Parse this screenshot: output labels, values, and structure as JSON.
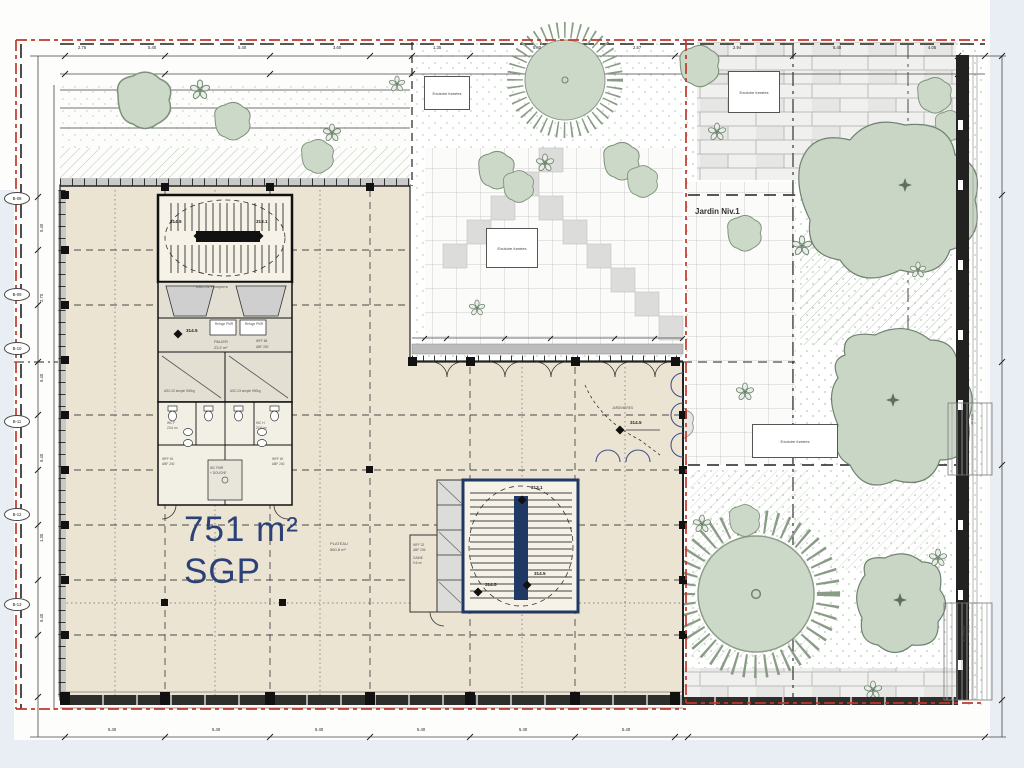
{
  "main_floor": {
    "area": "751 m²",
    "name": "SGP",
    "plateau_label": "PLATEAU",
    "plateau_area": "560.8 m²"
  },
  "garden": {
    "name": "Jardin Niv.1",
    "vent_label": "Exutoire fumées",
    "planters_label": "JARDINIÈRES",
    "terrace_label": "TERRASSE",
    "terrace_area": "30.8 m²"
  },
  "core1": {
    "stair_left_level": "314.5",
    "stair_right_level": "313.1",
    "lobby_level": "314.5",
    "elevator1": "ASC.01 Pompiers",
    "elevator2": "ASC.02 simple 900kg",
    "elevator3": "ASC.03 simple 900kg",
    "refuge": "Refuge PMR",
    "palier": "PALIER",
    "palier_area": "23.2 m²",
    "wff68": "WFF 68",
    "abf250": "ABF 250"
  },
  "wc": {
    "wc_f": "WC F",
    "wc_h": "WC H",
    "wc_area": "23.6 m²",
    "wc_pmr": "WC PMR",
    "douche": "+ DOUCHE",
    "wff40": "WFF 40",
    "abf240": "ABF 240"
  },
  "core2": {
    "top_level": "313.1",
    "bottom_level": "314.5",
    "side_level": "314.5",
    "wff32": "WFF 32",
    "abf206": "ABF 206",
    "gaine": "GAINE",
    "gaine_area": "9.6 m²"
  },
  "garden_spot_level": "314.5",
  "grid_bubbles": [
    "B-08",
    "B-09",
    "B-10",
    "B-11",
    "B-12",
    "B-13"
  ],
  "dims_top": [
    "2.75",
    "5.40",
    "5.40",
    "3.60",
    "1.35",
    "5.40",
    "2.57",
    "2.94",
    "5.40",
    "4.05"
  ],
  "dims_bottom": [
    "5.40",
    "5.40",
    "5.40",
    "5.40",
    "5.40",
    "5.40"
  ],
  "dims_left": [
    "5.40",
    "2.70",
    "5.40",
    "5.40",
    "1.35",
    "5.40"
  ],
  "colors": {
    "floor": "#ece4d3",
    "accent_navy": "#2b4178",
    "boundary_red": "#c0392b",
    "garden_green": "#cdd9c8"
  }
}
